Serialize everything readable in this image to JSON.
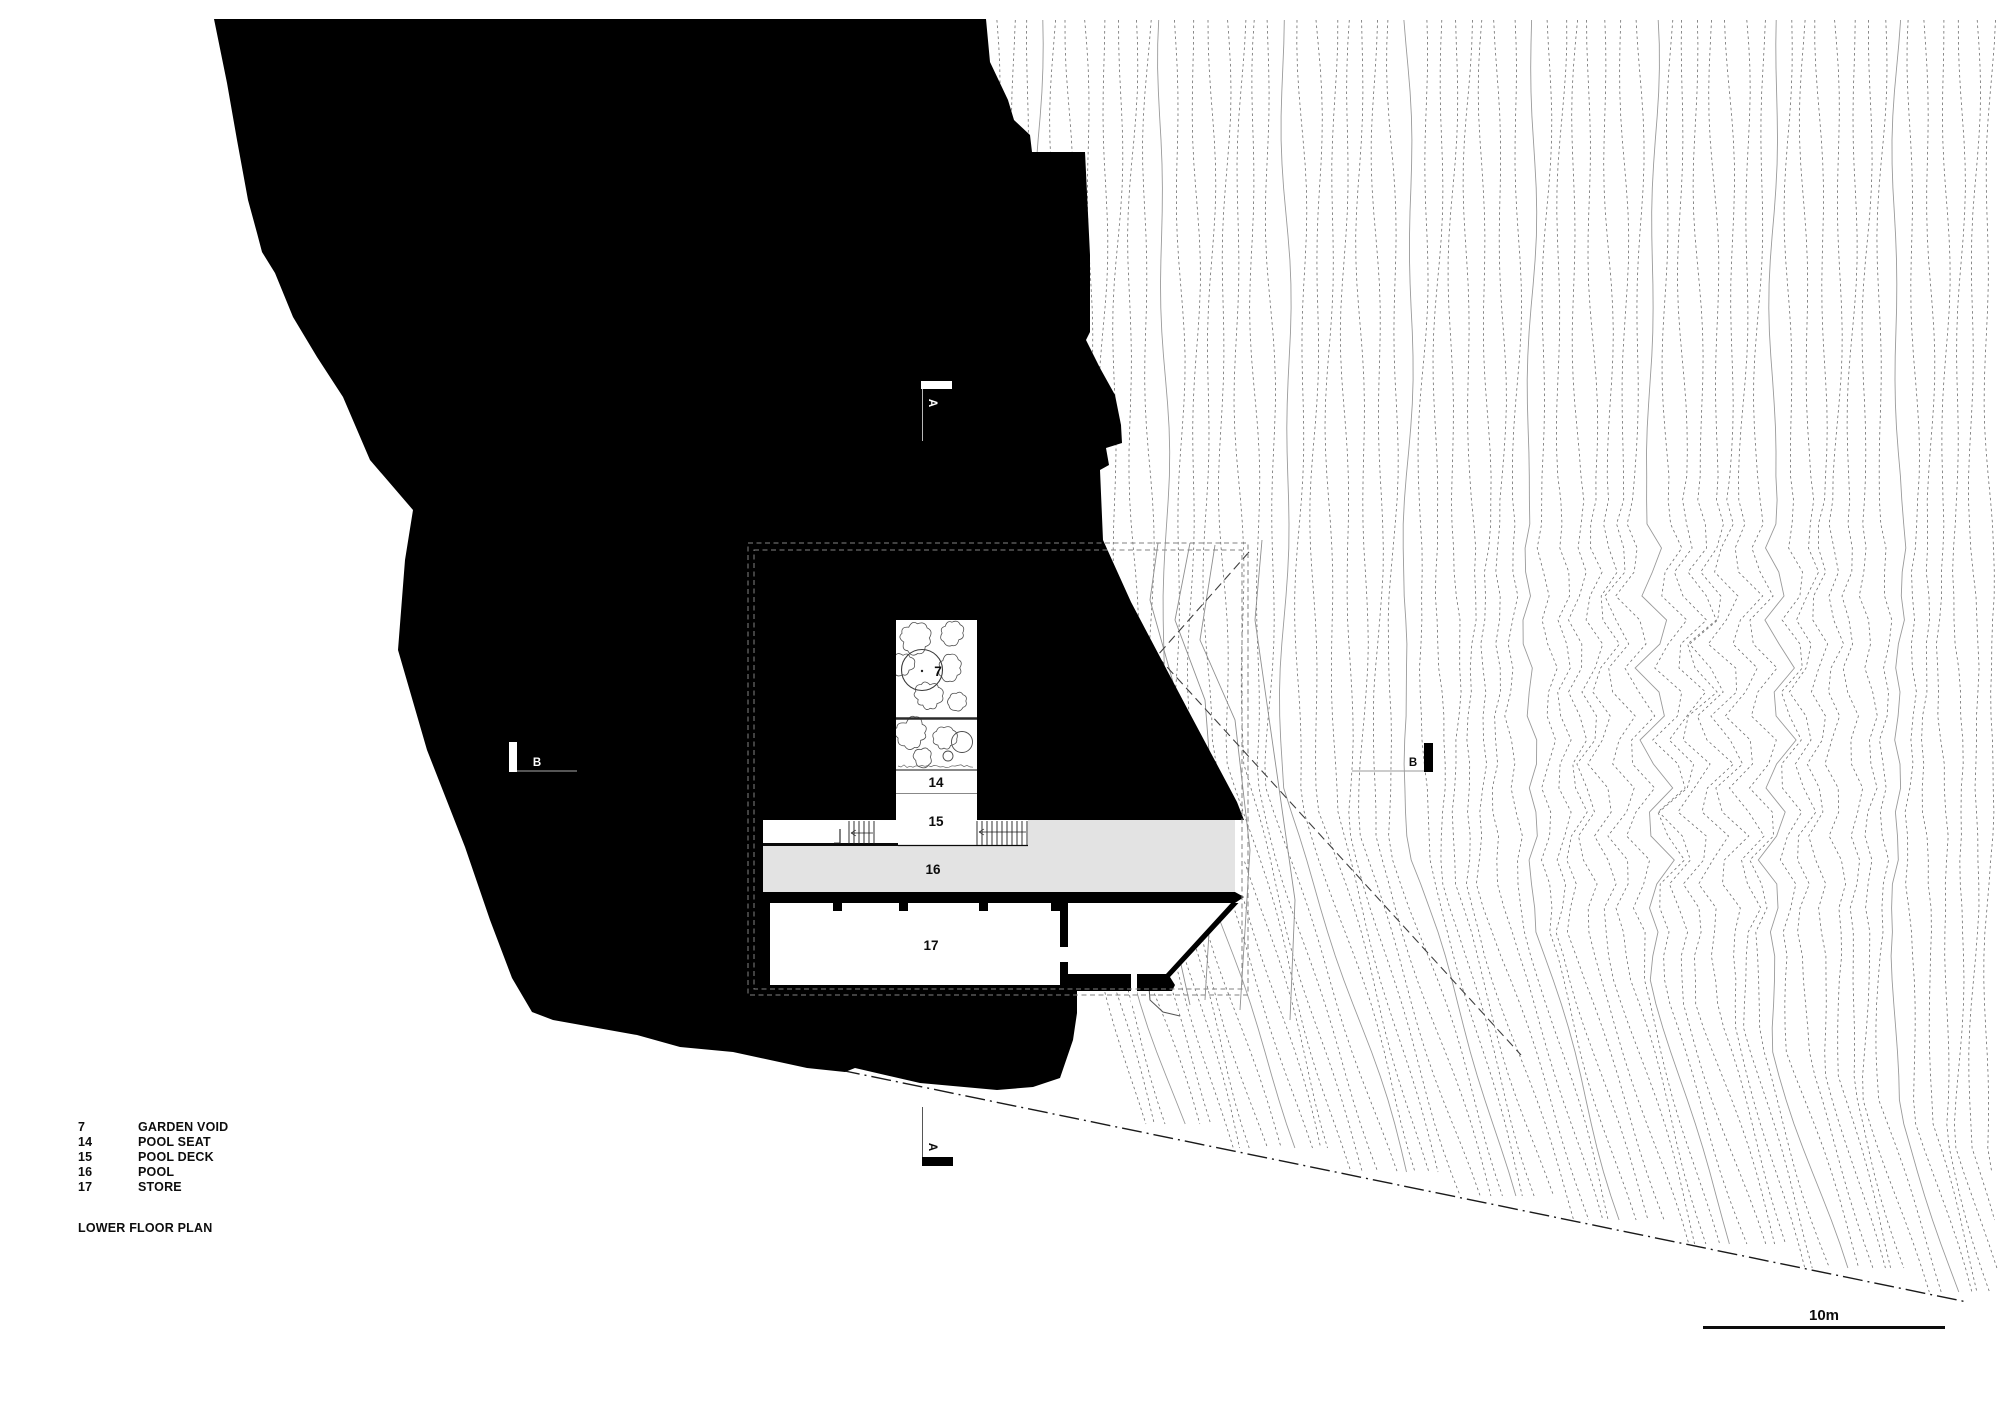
{
  "title": "LOWER FLOOR PLAN",
  "legend": {
    "items": [
      {
        "num": "7",
        "label": "GARDEN VOID"
      },
      {
        "num": "14",
        "label": "POOL SEAT"
      },
      {
        "num": "15",
        "label": "POOL DECK"
      },
      {
        "num": "16",
        "label": "POOL"
      },
      {
        "num": "17",
        "label": "STORE"
      }
    ]
  },
  "rooms": {
    "garden_void": "7",
    "pool_seat": "14",
    "pool_deck": "15",
    "pool": "16",
    "store": "17"
  },
  "sections": {
    "a": "A",
    "b": "B"
  },
  "scale": {
    "label": "10m"
  },
  "colors": {
    "paper": "#ffffff",
    "poche": "#000000",
    "pool": "#e3e3e3",
    "contour_dash": "#6e6e6e",
    "contour_solid": "#9a9a9a",
    "dashed_rect": "#828282",
    "boundary": "#1a1a1a",
    "site_line": "#3f3f3f"
  }
}
